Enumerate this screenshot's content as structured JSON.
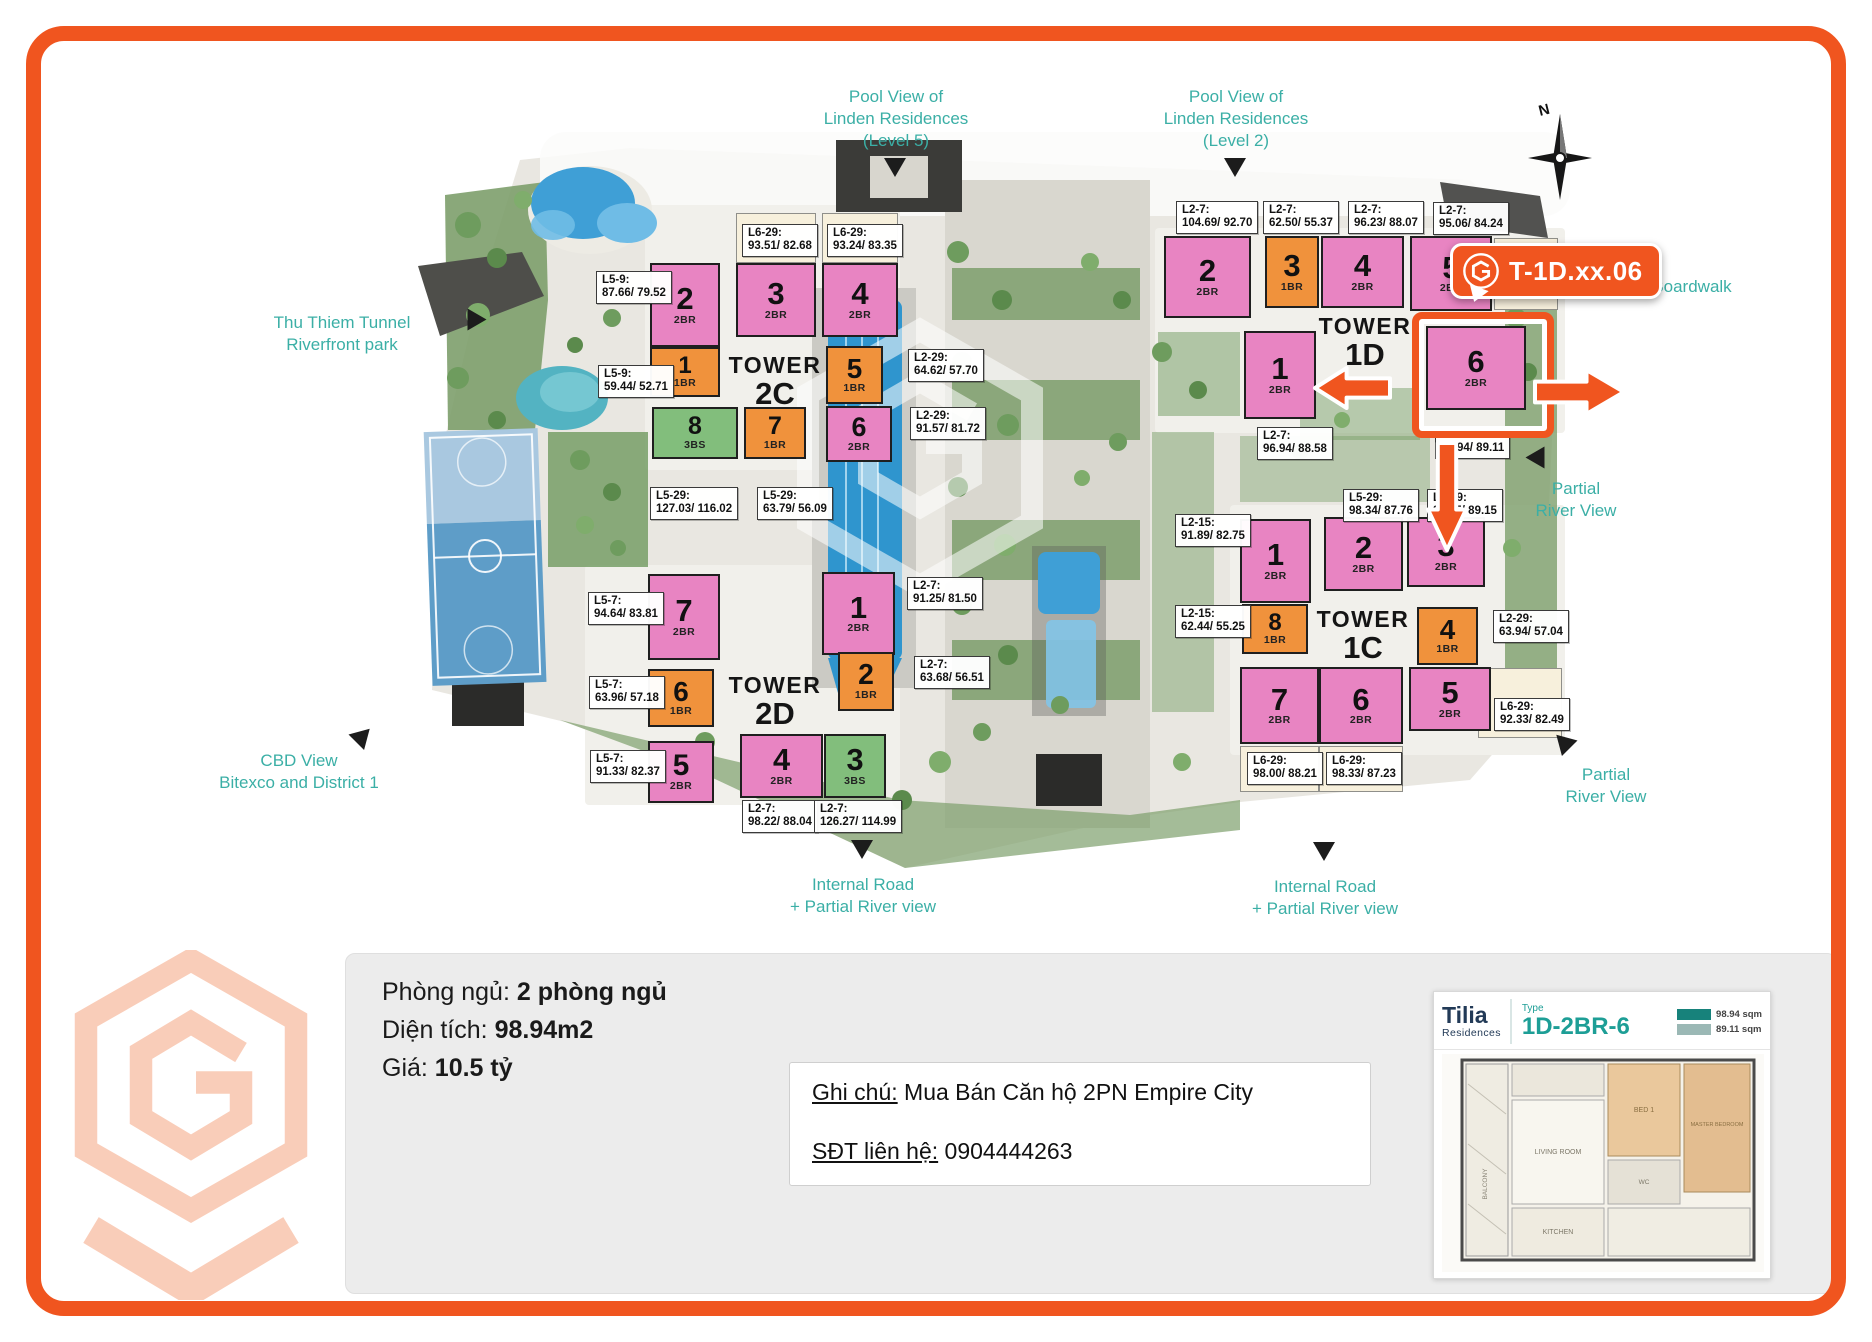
{
  "brand": {
    "orange": "#F0551F",
    "salmon": "#F9CDB9",
    "teal": "#3BAFA6"
  },
  "map": {
    "callout_text": "T-1D.xx.06",
    "compass_label": "N",
    "highlight": {
      "x": 1412,
      "y": 312,
      "w": 128,
      "h": 112
    },
    "towers": [
      {
        "id": "2C",
        "line1": "TOWER",
        "line2": "2C",
        "x": 775,
        "y": 352
      },
      {
        "id": "2D",
        "line1": "TOWER",
        "line2": "2D",
        "x": 775,
        "y": 672
      },
      {
        "id": "1D",
        "line1": "TOWER",
        "line2": "1D",
        "x": 1365,
        "y": 313
      },
      {
        "id": "1C",
        "line1": "TOWER",
        "line2": "1C",
        "x": 1363,
        "y": 606
      }
    ],
    "units": [
      {
        "t": "2C",
        "n": "2",
        "ty": "2BR",
        "c": "pink",
        "x": 650,
        "y": 263,
        "w": 70,
        "h": 84
      },
      {
        "t": "2C",
        "n": "3",
        "ty": "2BR",
        "c": "pink",
        "x": 736,
        "y": 263,
        "w": 80,
        "h": 74
      },
      {
        "t": "2C",
        "n": "4",
        "ty": "2BR",
        "c": "pink",
        "x": 822,
        "y": 263,
        "w": 76,
        "h": 74
      },
      {
        "t": "2C",
        "n": "1",
        "ty": "1BR",
        "c": "orange",
        "x": 650,
        "y": 347,
        "w": 70,
        "h": 50
      },
      {
        "t": "2C",
        "n": "5",
        "ty": "1BR",
        "c": "orange",
        "x": 826,
        "y": 346,
        "w": 57,
        "h": 58
      },
      {
        "t": "2C",
        "n": "8",
        "ty": "3BS",
        "c": "green",
        "x": 652,
        "y": 407,
        "w": 86,
        "h": 52
      },
      {
        "t": "2C",
        "n": "7",
        "ty": "1BR",
        "c": "orange",
        "x": 744,
        "y": 407,
        "w": 62,
        "h": 52
      },
      {
        "t": "2C",
        "n": "6",
        "ty": "2BR",
        "c": "pink",
        "x": 826,
        "y": 406,
        "w": 66,
        "h": 56
      },
      {
        "t": "2D",
        "n": "7",
        "ty": "2BR",
        "c": "pink",
        "x": 648,
        "y": 574,
        "w": 72,
        "h": 86
      },
      {
        "t": "2D",
        "n": "6",
        "ty": "1BR",
        "c": "orange",
        "x": 648,
        "y": 669,
        "w": 66,
        "h": 58
      },
      {
        "t": "2D",
        "n": "5",
        "ty": "2BR",
        "c": "pink",
        "x": 648,
        "y": 741,
        "w": 66,
        "h": 62
      },
      {
        "t": "2D",
        "n": "1",
        "ty": "2BR",
        "c": "pink",
        "x": 822,
        "y": 572,
        "w": 73,
        "h": 83
      },
      {
        "t": "2D",
        "n": "2",
        "ty": "1BR",
        "c": "orange",
        "x": 838,
        "y": 652,
        "w": 56,
        "h": 59
      },
      {
        "t": "2D",
        "n": "4",
        "ty": "2BR",
        "c": "pink",
        "x": 740,
        "y": 734,
        "w": 83,
        "h": 64
      },
      {
        "t": "2D",
        "n": "3",
        "ty": "3BS",
        "c": "green",
        "x": 824,
        "y": 734,
        "w": 62,
        "h": 64
      },
      {
        "t": "1D",
        "n": "2",
        "ty": "2BR",
        "c": "pink",
        "x": 1164,
        "y": 236,
        "w": 87,
        "h": 82
      },
      {
        "t": "1D",
        "n": "3",
        "ty": "1BR",
        "c": "orange",
        "x": 1265,
        "y": 236,
        "w": 54,
        "h": 72
      },
      {
        "t": "1D",
        "n": "4",
        "ty": "2BR",
        "c": "pink",
        "x": 1321,
        "y": 236,
        "w": 83,
        "h": 72
      },
      {
        "t": "1D",
        "n": "5",
        "ty": "2BR",
        "c": "pink",
        "x": 1410,
        "y": 236,
        "w": 82,
        "h": 75
      },
      {
        "t": "1D",
        "n": "1",
        "ty": "2BR",
        "c": "pink",
        "x": 1244,
        "y": 331,
        "w": 72,
        "h": 88
      },
      {
        "t": "1D",
        "n": "6",
        "ty": "2BR",
        "c": "pink",
        "x": 1426,
        "y": 326,
        "w": 100,
        "h": 84
      },
      {
        "t": "1C",
        "n": "1",
        "ty": "2BR",
        "c": "pink",
        "x": 1240,
        "y": 519,
        "w": 71,
        "h": 84
      },
      {
        "t": "1C",
        "n": "2",
        "ty": "2BR",
        "c": "pink",
        "x": 1324,
        "y": 517,
        "w": 79,
        "h": 74
      },
      {
        "t": "1C",
        "n": "3",
        "ty": "2BR",
        "c": "pink",
        "x": 1407,
        "y": 517,
        "w": 78,
        "h": 70
      },
      {
        "t": "1C",
        "n": "8",
        "ty": "1BR",
        "c": "orange",
        "x": 1242,
        "y": 604,
        "w": 66,
        "h": 50
      },
      {
        "t": "1C",
        "n": "4",
        "ty": "1BR",
        "c": "orange",
        "x": 1417,
        "y": 607,
        "w": 61,
        "h": 58
      },
      {
        "t": "1C",
        "n": "7",
        "ty": "2BR",
        "c": "pink",
        "x": 1240,
        "y": 667,
        "w": 79,
        "h": 77
      },
      {
        "t": "1C",
        "n": "6",
        "ty": "2BR",
        "c": "pink",
        "x": 1319,
        "y": 667,
        "w": 84,
        "h": 77
      },
      {
        "t": "1C",
        "n": "5",
        "ty": "2BR",
        "c": "pink",
        "x": 1409,
        "y": 667,
        "w": 82,
        "h": 64
      }
    ],
    "cream_boxes": [
      {
        "x": 736,
        "y": 213,
        "w": 80,
        "h": 50
      },
      {
        "x": 822,
        "y": 213,
        "w": 76,
        "h": 50
      },
      {
        "x": 1240,
        "y": 746,
        "w": 79,
        "h": 46
      },
      {
        "x": 1319,
        "y": 746,
        "w": 84,
        "h": 46
      },
      {
        "x": 1494,
        "y": 238,
        "w": 64,
        "h": 72
      },
      {
        "x": 1478,
        "y": 668,
        "w": 84,
        "h": 70
      }
    ],
    "area_labels": [
      {
        "l1": "L5-9:",
        "l2": "87.66/ 79.52",
        "x": 596,
        "y": 271
      },
      {
        "l1": "L5-9:",
        "l2": "59.44/ 52.71",
        "x": 598,
        "y": 365
      },
      {
        "l1": "L6-29:",
        "l2": "93.51/ 82.68",
        "x": 742,
        "y": 224
      },
      {
        "l1": "L6-29:",
        "l2": "93.24/ 83.35",
        "x": 827,
        "y": 224
      },
      {
        "l1": "L2-29:",
        "l2": "64.62/ 57.70",
        "x": 908,
        "y": 349
      },
      {
        "l1": "L2-29:",
        "l2": "91.57/ 81.72",
        "x": 910,
        "y": 407
      },
      {
        "l1": "L5-29:",
        "l2": "127.03/ 116.02",
        "x": 650,
        "y": 487
      },
      {
        "l1": "L5-29:",
        "l2": "63.79/ 56.09",
        "x": 757,
        "y": 487
      },
      {
        "l1": "L5-7:",
        "l2": "94.64/ 83.81",
        "x": 588,
        "y": 592
      },
      {
        "l1": "L5-7:",
        "l2": "63.96/ 57.18",
        "x": 589,
        "y": 676
      },
      {
        "l1": "L5-7:",
        "l2": "91.33/ 82.37",
        "x": 590,
        "y": 750
      },
      {
        "l1": "L2-7:",
        "l2": "91.25/ 81.50",
        "x": 907,
        "y": 577
      },
      {
        "l1": "L2-7:",
        "l2": "63.68/ 56.51",
        "x": 914,
        "y": 656
      },
      {
        "l1": "L2-7:",
        "l2": "98.22/ 88.04",
        "x": 742,
        "y": 800
      },
      {
        "l1": "L2-7:",
        "l2": "126.27/ 114.99",
        "x": 814,
        "y": 800
      },
      {
        "l1": "L2-7:",
        "l2": "104.69/ 92.70",
        "x": 1176,
        "y": 201
      },
      {
        "l1": "L2-7:",
        "l2": "62.50/ 55.37",
        "x": 1263,
        "y": 201
      },
      {
        "l1": "L2-7:",
        "l2": "96.23/ 88.07",
        "x": 1348,
        "y": 201
      },
      {
        "l1": "L2-7:",
        "l2": "95.06/ 84.24",
        "x": 1433,
        "y": 202
      },
      {
        "l1": "L2-7:",
        "l2": "96.94/ 88.58",
        "x": 1257,
        "y": 427
      },
      {
        "l1": "L2-7:",
        "l2": "98.94/ 89.11",
        "x": 1435,
        "y": 426
      },
      {
        "l1": "L2-15:",
        "l2": "91.89/ 82.75",
        "x": 1175,
        "y": 514
      },
      {
        "l1": "L5-29:",
        "l2": "98.34/ 87.76",
        "x": 1343,
        "y": 489
      },
      {
        "l1": "L5-29:",
        "l2": "98.75/ 89.15",
        "x": 1427,
        "y": 489
      },
      {
        "l1": "L2-15:",
        "l2": "62.44/ 55.25",
        "x": 1175,
        "y": 605
      },
      {
        "l1": "L2-29:",
        "l2": "63.94/ 57.04",
        "x": 1493,
        "y": 610
      },
      {
        "l1": "L6-29:",
        "l2": "98.00/ 88.21",
        "x": 1247,
        "y": 752
      },
      {
        "l1": "L6-29:",
        "l2": "98.33/ 87.23",
        "x": 1326,
        "y": 752
      },
      {
        "l1": "L6-29:",
        "l2": "92.33/ 82.49",
        "x": 1494,
        "y": 698
      }
    ],
    "view_labels": [
      {
        "id": "pool-view-level5",
        "text": "Pool View of\nLinden Residences\n(Level 5)",
        "x": 896,
        "y": 86,
        "arrow": {
          "x": 884,
          "y": 158,
          "dir": "down"
        }
      },
      {
        "id": "pool-view-level2",
        "text": "Pool View of\nLinden Residences\n(Level 2)",
        "x": 1236,
        "y": 86,
        "arrow": {
          "x": 1224,
          "y": 158,
          "dir": "down"
        }
      },
      {
        "id": "thu-thiem-tunnel",
        "text": "Thu Thiem Tunnel\nRiverfront park",
        "x": 342,
        "y": 312,
        "arrow": {
          "x": 466,
          "y": 310,
          "dir": "right"
        }
      },
      {
        "id": "cbd-view",
        "text": "CBD View\nBitexco and District 1",
        "x": 299,
        "y": 750,
        "arrow": {
          "x": 352,
          "y": 726,
          "dir": "upright"
        }
      },
      {
        "id": "partial-river-view-1",
        "text": "Partial\nRiver View",
        "x": 1576,
        "y": 478,
        "arrow": {
          "x": 1524,
          "y": 448,
          "dir": "left"
        }
      },
      {
        "id": "partial-river-view-2",
        "text": "Partial\nRiver View",
        "x": 1606,
        "y": 764,
        "arrow": {
          "x": 1552,
          "y": 732,
          "dir": "upleft"
        }
      },
      {
        "id": "internal-road-1",
        "text": "Internal Road\n+ Partial River view",
        "x": 863,
        "y": 874,
        "arrow": {
          "x": 851,
          "y": 840,
          "dir": "down"
        }
      },
      {
        "id": "internal-road-2",
        "text": "Internal Road\n+ Partial River view",
        "x": 1325,
        "y": 876,
        "arrow": {
          "x": 1313,
          "y": 842,
          "dir": "down"
        }
      },
      {
        "id": "boardwalk",
        "text": "Boardwalk",
        "x": 1692,
        "y": 276
      }
    ],
    "arrows": [
      {
        "dir": "left",
        "x": 1313,
        "y": 364,
        "w": 80,
        "h": 48
      },
      {
        "dir": "down",
        "x": 1424,
        "y": 440,
        "w": 46,
        "h": 112
      },
      {
        "dir": "right",
        "x": 1532,
        "y": 366,
        "w": 94,
        "h": 52
      }
    ]
  },
  "info": {
    "rows": [
      {
        "label": "Phòng ngủ: ",
        "value": "2 phòng ngủ"
      },
      {
        "label": "Diện tích: ",
        "value": "98.94m2"
      },
      {
        "label": "Giá: ",
        "value": "10.5 tỷ"
      }
    ],
    "note_line1_label": "Ghi chú:",
    "note_line1_text": " Mua Bán Căn hộ 2PN Empire City",
    "note_line2_label": "SĐT liên hệ:",
    "note_line2_text": " 0904444263"
  },
  "card": {
    "brand_top": "Tilia",
    "brand_sub": "Residences",
    "type_label": "Type",
    "type_value": "1D-2BR-6",
    "area_values": [
      "98.94 sqm",
      "89.11 sqm"
    ],
    "rooms": [
      "BALCONY",
      "LIVING ROOM",
      "KITCHEN",
      "BED 1",
      "MASTER BEDROOM",
      "WC"
    ]
  }
}
